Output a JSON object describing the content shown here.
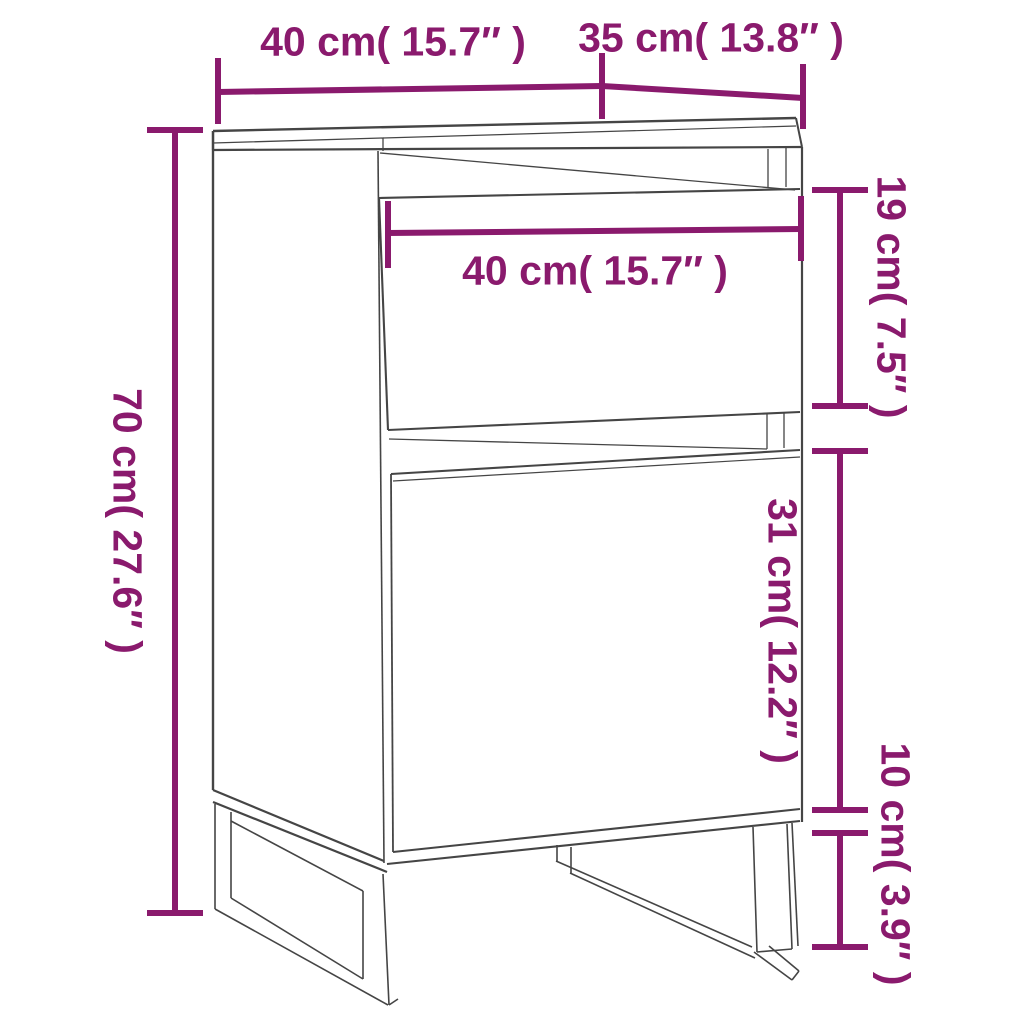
{
  "diagram": {
    "title": "Cabinet dimension line drawing",
    "type": "furniture-dimension-diagram",
    "background_color": "#ffffff",
    "accent_color": "#8A1A6D",
    "line_color": "#454545",
    "units": [
      "cm",
      "inches"
    ],
    "dimensions": {
      "top_width": {
        "label": "40 cm( 15.7″ )",
        "value_cm": 40,
        "value_in": 15.7,
        "measures": "top panel width",
        "orientation": "horizontal"
      },
      "top_depth": {
        "label": "35 cm( 13.8″ )",
        "value_cm": 35,
        "value_in": 13.8,
        "measures": "top panel depth",
        "orientation": "horizontal"
      },
      "overall_height": {
        "label": "70 cm( 27.6″ )",
        "value_cm": 70,
        "value_in": 27.6,
        "measures": "overall height",
        "orientation": "vertical"
      },
      "drawer_width": {
        "label": "40 cm( 15.7″ )",
        "value_cm": 40,
        "value_in": 15.7,
        "measures": "drawer width",
        "orientation": "horizontal"
      },
      "drawer_height": {
        "label": "19 cm( 7.5″ )",
        "value_cm": 19,
        "value_in": 7.5,
        "measures": "drawer height",
        "orientation": "vertical"
      },
      "door_height": {
        "label": "31 cm( 12.2″ )",
        "value_cm": 31,
        "value_in": 12.2,
        "measures": "door height",
        "orientation": "vertical"
      },
      "leg_height": {
        "label": "10 cm( 3.9″ )",
        "value_cm": 10,
        "value_in": 3.9,
        "measures": "leg height",
        "orientation": "vertical"
      }
    }
  }
}
